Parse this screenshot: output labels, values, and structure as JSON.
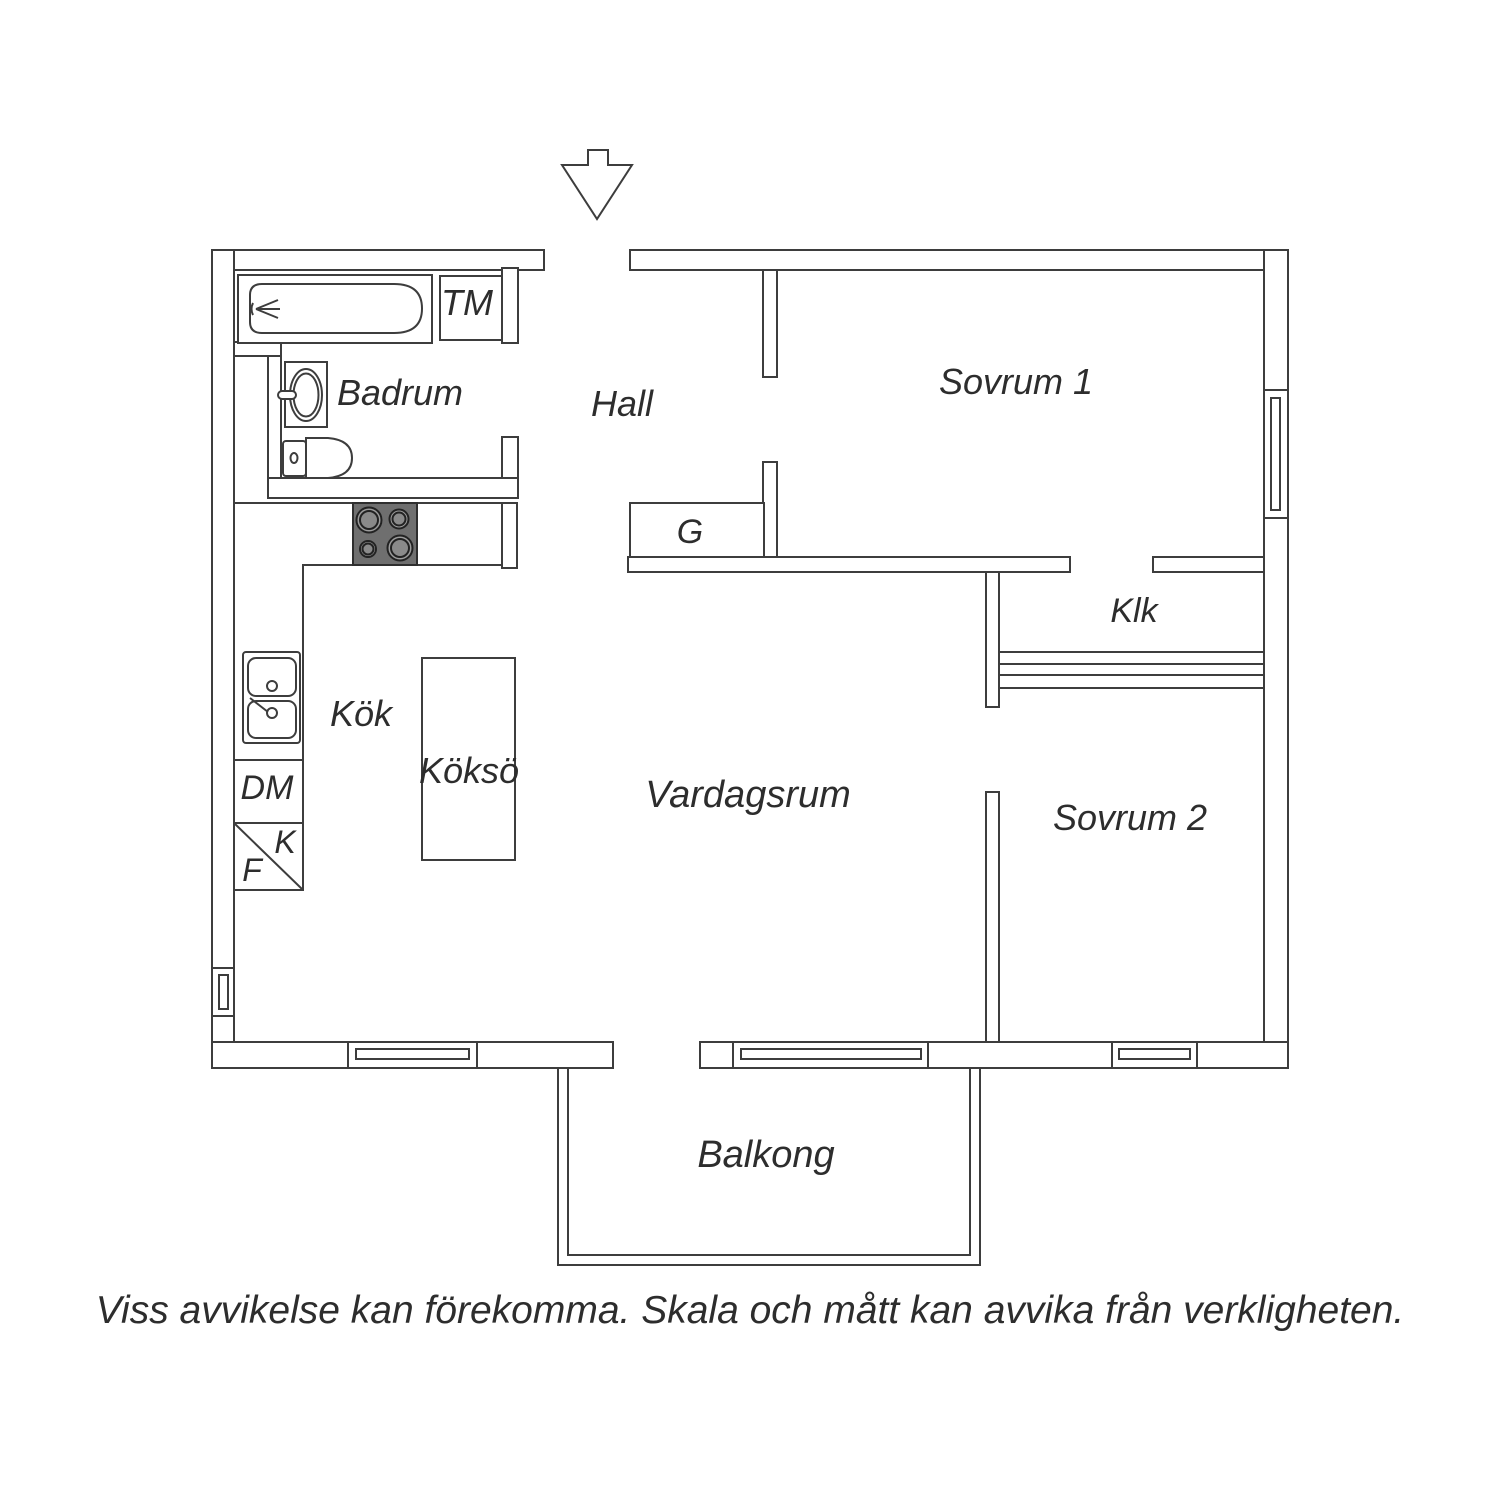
{
  "floorplan": {
    "labels": {
      "badrum": "Badrum",
      "hall": "Hall",
      "sovrum1": "Sovrum 1",
      "klk": "Klk",
      "kok": "Kök",
      "kokso": "Köksö",
      "vardagsrum": "Vardagsrum",
      "sovrum2": "Sovrum 2",
      "balkong": "Balkong",
      "tm": "TM",
      "g": "G",
      "dm": "DM",
      "k": "K",
      "f": "F"
    },
    "disclaimer": "Viss avvikelse kan förekomma. Skala och mått kan avvika från verkligheten.",
    "colors": {
      "line": "#3d3d3d",
      "text": "#2d2d2d",
      "stove_fill": "#6f6f6f",
      "burner_fill": "#9c9c9c",
      "burner_inner_fill": "#8a8a8a",
      "background": "#ffffff"
    },
    "icons": {
      "entrance": "entrance-arrow-icon",
      "bath": "bathtub-icon",
      "basin": "washbasin-icon",
      "wc": "toilet-icon",
      "hob": "stove-icon",
      "sink": "kitchen-sink-icon",
      "windows": "window-icon",
      "railing": "balcony-railing-icon"
    }
  }
}
